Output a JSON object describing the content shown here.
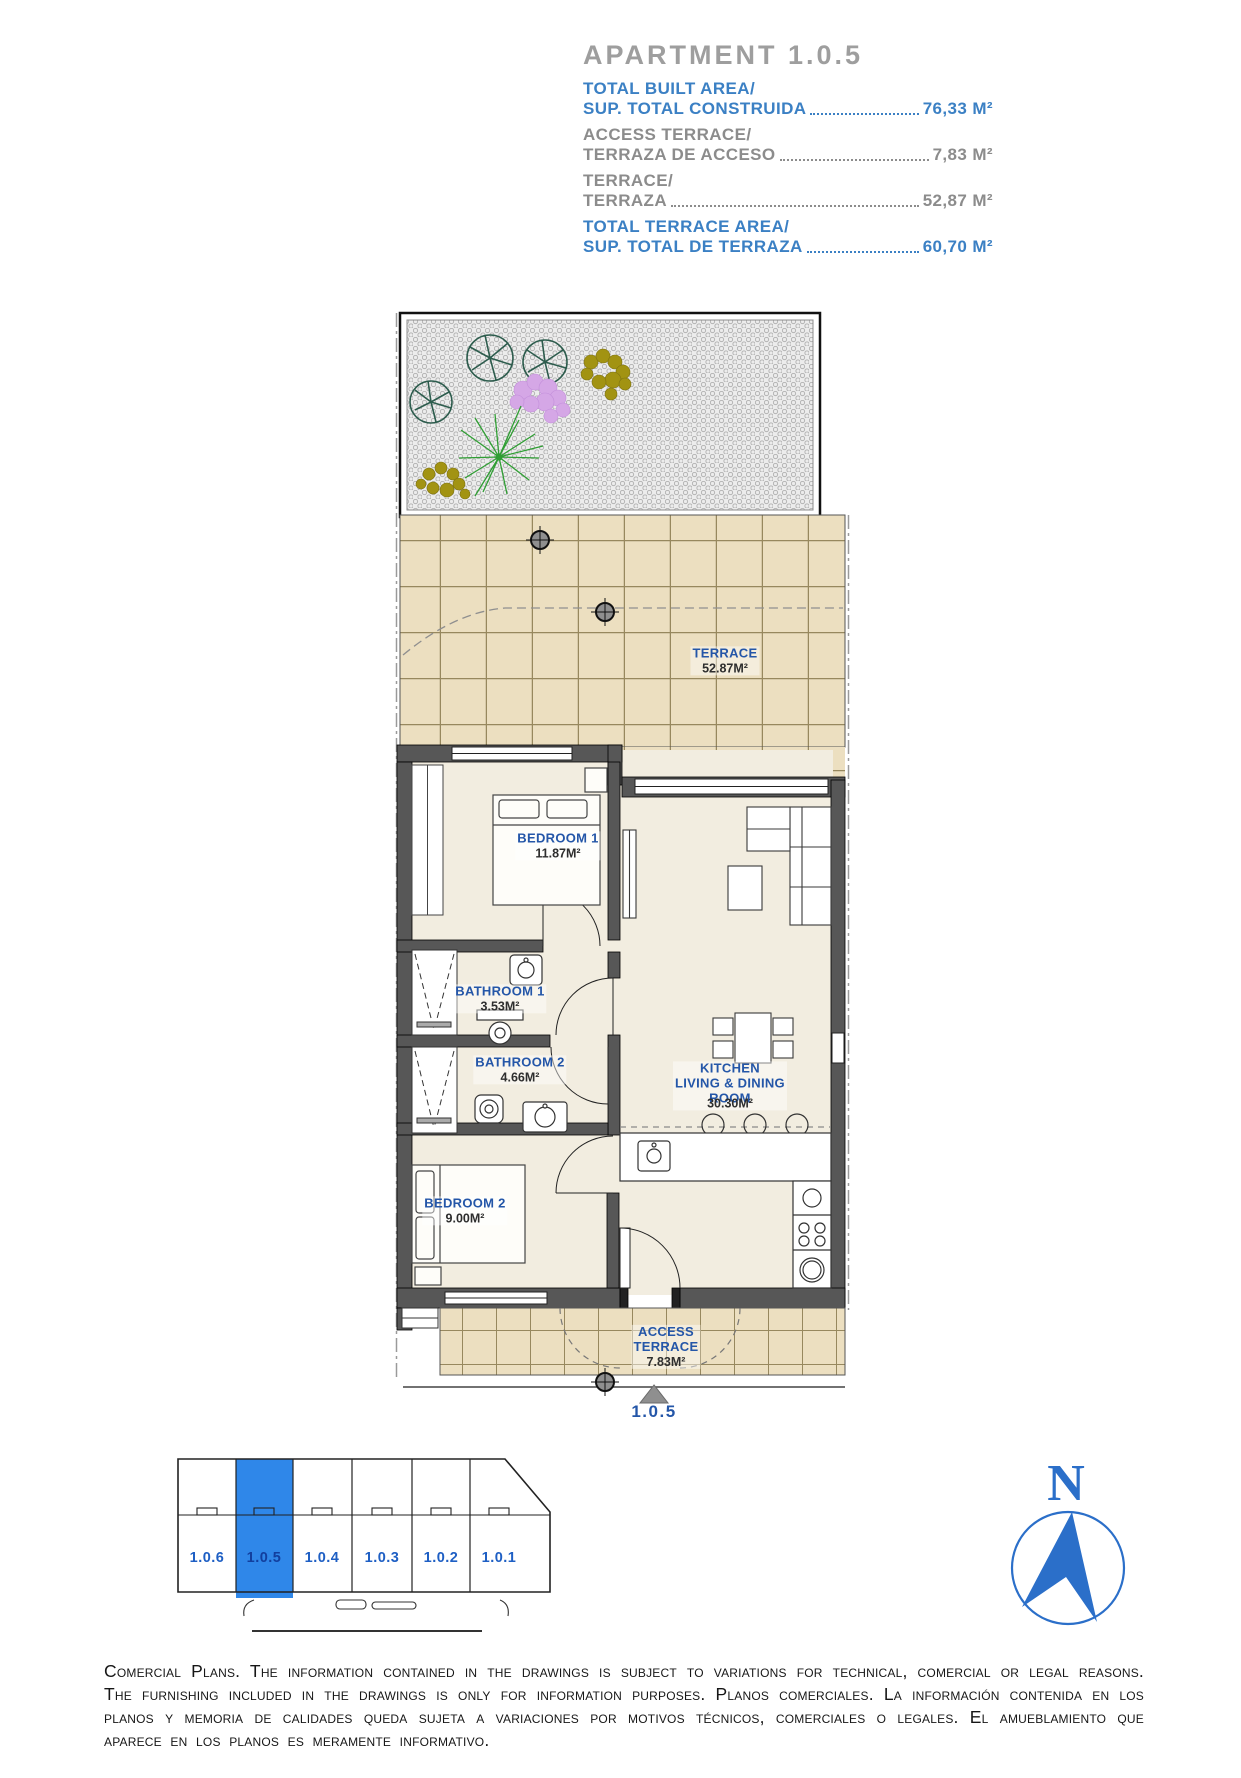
{
  "header": {
    "title": "APARTMENT 1.0.5",
    "rows": [
      {
        "label_en": "TOTAL BUILT AREA/",
        "label_es": "SUP. TOTAL CONSTRUIDA",
        "value": "76,33 M²",
        "style": "accent"
      },
      {
        "label_en": "ACCESS TERRACE/",
        "label_es": "TERRAZA DE ACCESO",
        "value": "7,83 M²",
        "style": "muted"
      },
      {
        "label_en": "TERRACE/",
        "label_es": "TERRAZA",
        "value": "52,87 M²",
        "style": "muted"
      },
      {
        "label_en": "TOTAL TERRACE AREA/",
        "label_es": "SUP. TOTAL DE TERRAZA",
        "value": "60,70 M²",
        "style": "accent"
      }
    ]
  },
  "plan": {
    "terrace": {
      "name": "TERRACE",
      "area": "52.87M²"
    },
    "bedroom1": {
      "name": "BEDROOM 1",
      "area": "11.87M²"
    },
    "bathroom1": {
      "name": "BATHROOM 1",
      "area": "3.53M²"
    },
    "bathroom2": {
      "name": "BATHROOM 2",
      "area": "4.66M²"
    },
    "kitchen": {
      "name_line1": "KITCHEN",
      "name_line2": "LIVING & DINING",
      "name_line3": "ROOM",
      "area": "30.30M²"
    },
    "bedroom2": {
      "name": "BEDROOM 2",
      "area": "9.00M²"
    },
    "access_terrace": {
      "name_line1": "ACCESS",
      "name_line2": "TERRACE",
      "area": "7.83M²"
    },
    "unit_number": "1.0.5"
  },
  "locator": {
    "units": [
      {
        "label": "1.0.6",
        "highlighted": false
      },
      {
        "label": "1.0.5",
        "highlighted": true
      },
      {
        "label": "1.0.4",
        "highlighted": false
      },
      {
        "label": "1.0.3",
        "highlighted": false
      },
      {
        "label": "1.0.2",
        "highlighted": false
      },
      {
        "label": "1.0.1",
        "highlighted": false
      }
    ]
  },
  "compass": {
    "north_label": "N"
  },
  "disclaimer": {
    "text": "Comercial Plans. The information contained in the drawings is subject to variations for technical, comercial or legal reasons. The furnishing included in the drawings is only for information purposes. Planos comerciales. La información contenida en los planos y memoria de calidades queda sujeta a variaciones por motivos técnicos, comerciales o legales. El amueblamiento que aparece en los planos es meramente informativo."
  },
  "colors": {
    "accent_blue": "#3b80c4",
    "muted_gray": "#8c8c8c",
    "title_gray": "#9e9e9e",
    "plan_label_blue": "#2456a8",
    "unit_highlight_blue": "#2f87e9",
    "compass_blue": "#2b6fc9",
    "tile_tan": "#ecdfc0",
    "wall_gray": "#575757"
  }
}
